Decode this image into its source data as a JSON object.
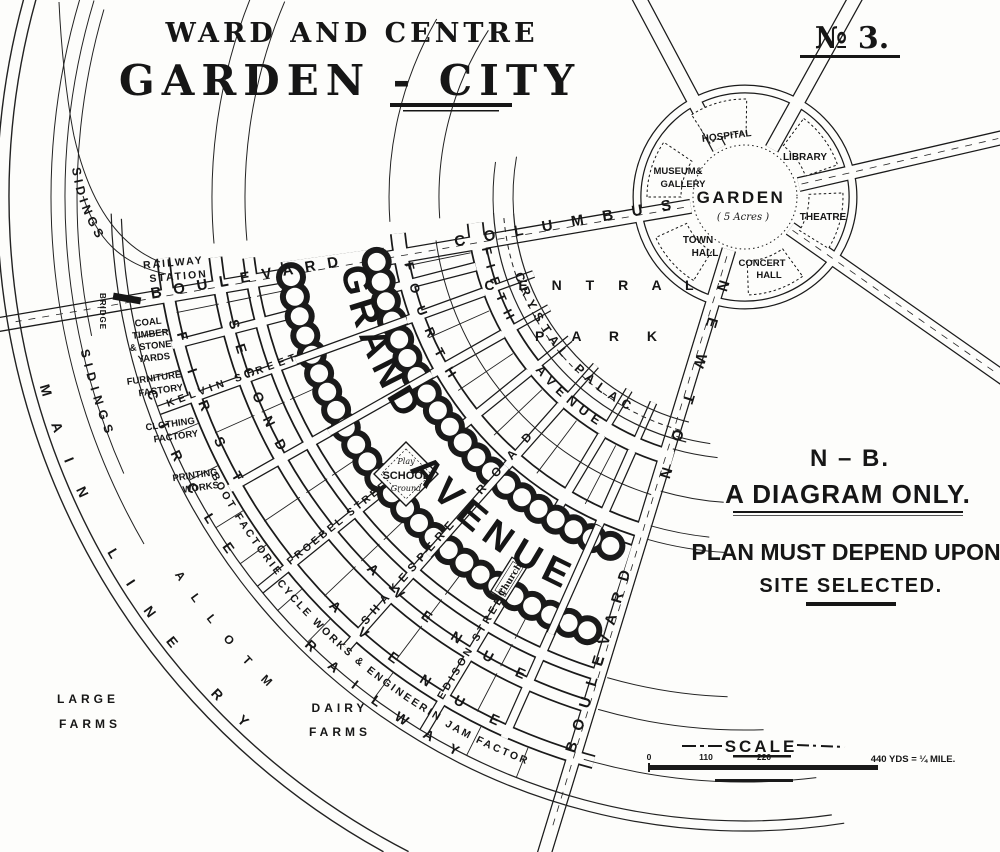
{
  "title": {
    "line1": "WARD AND CENTRE",
    "line2": "GARDEN - CITY",
    "plate_no": "№ 3."
  },
  "note": {
    "nb": "N – B.",
    "line1": "A DIAGRAM ONLY.",
    "line2": "PLAN MUST DEPEND UPON",
    "line3": "SITE SELECTED."
  },
  "scale": {
    "label": "SCALE",
    "t0": "0",
    "t110": "110",
    "t220": "220",
    "right_label": "440 YDS = ¼ MILE."
  },
  "hub": {
    "garden": "GARDEN",
    "garden_sub": "( 5 Acres )",
    "hospital": "HOSPITAL",
    "library": "LIBRARY",
    "theatre": "THEATRE",
    "concert_1": "CONCERT",
    "concert_2": "HALL",
    "town_1": "TOWN",
    "town_2": "HALL",
    "museum_1": "MUSEUM&",
    "museum_2": "GALLERY"
  },
  "blvd": {
    "columbus": "COLUMBUS",
    "columbus_word": "BOULEVARD",
    "newton": "NEWTON",
    "newton_word": "BOULEVARD"
  },
  "park": {
    "central": "C E N T R A L",
    "park": "P A R K"
  },
  "arcs": {
    "crystal": "CRYSTAL PALACE",
    "fifth": "FIFTH",
    "fifth_ave": "AVENUE",
    "fourth": "FOURTH",
    "grand": "GRAND",
    "grand_ave": "AVENUE",
    "second": "SECOND",
    "second_ave": "AVENUE",
    "first": "FIRST",
    "first_ave": "AVENUE",
    "circle": "CIRCLE",
    "railway": "RAILWAY"
  },
  "radials": {
    "kelvin": "KELVIN STREET",
    "froebel": "FROEBEL STREET",
    "shakespere": "SHAKESPERE",
    "shakespere_road": "ROAD",
    "edison": "EDISON STREET"
  },
  "features": {
    "school_top": "Play",
    "school": "SCHOOL",
    "school_bottom": "Ground",
    "church": "Church",
    "station_1": "RAILWAY",
    "station_2": "STATION",
    "bridge": "BRIDGE"
  },
  "industry": {
    "coal_1": "COAL",
    "coal_2": "TIMBER",
    "coal_3": "& STONE",
    "coal_4": "YARDS",
    "furniture_1": "FURNITURE",
    "furniture_2": "FACTORY",
    "clothing_1": "CLOTHING",
    "clothing_2": "FACTORY",
    "printing_1": "PRINTING",
    "printing_2": "WORKS",
    "boot": "BOOT FACTORIES",
    "cycle": "CYCLE WORKS & ENGINEERING",
    "jam": "JAM FACTORY"
  },
  "outer": {
    "allotments": "A L L O T M E N T S",
    "dairy_1": "DAIRY",
    "dairy_2": "FARMS",
    "large_1": "LARGE",
    "large_2": "FARMS",
    "main_line": "MAIN LINE RY",
    "sidings_upper": "SIDINGS",
    "sidings_lower": "SIDINGS"
  }
}
